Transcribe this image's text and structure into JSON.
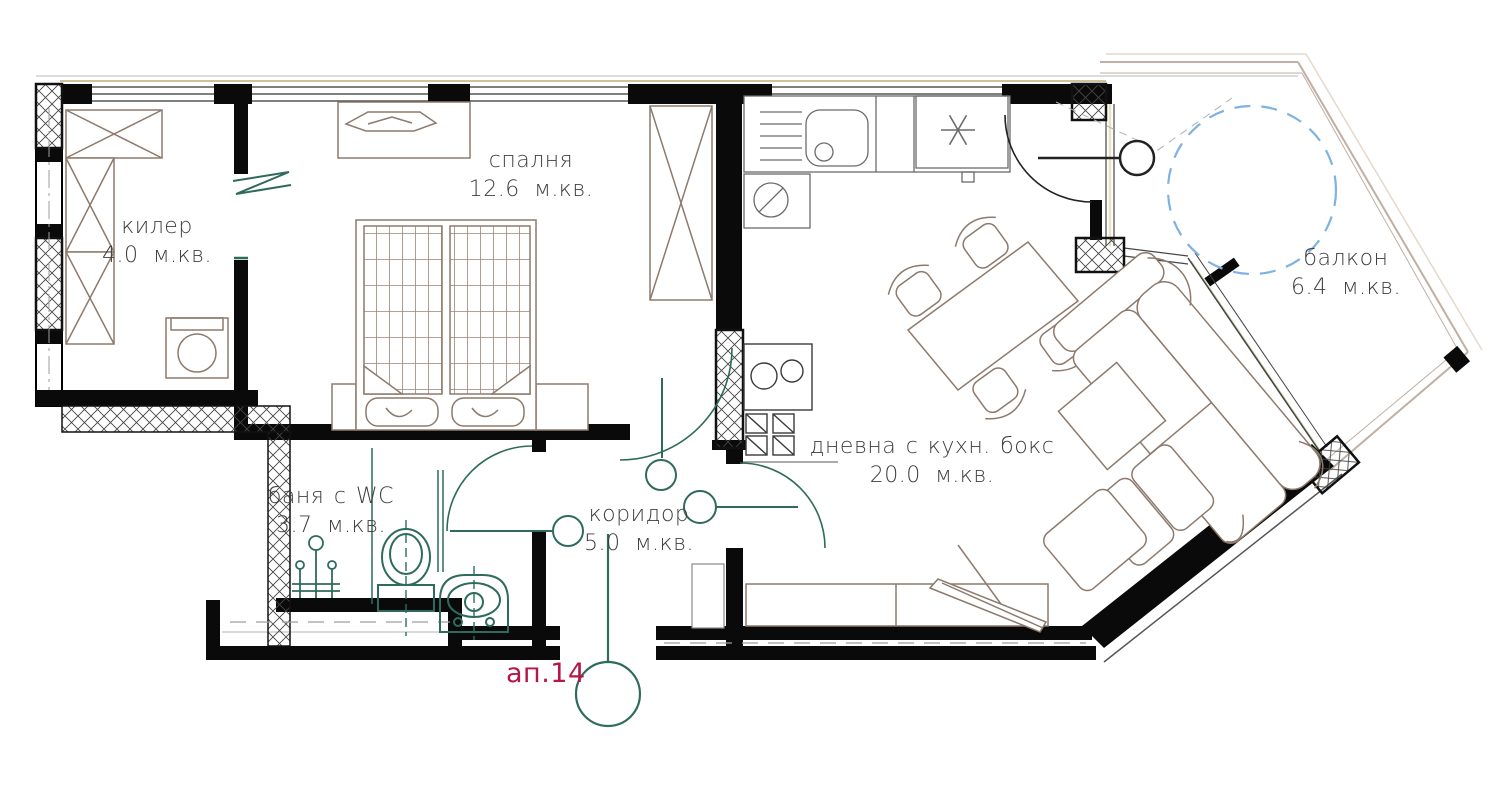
{
  "plan": {
    "apartment_label": "ап.14",
    "rooms": [
      {
        "key": "storage",
        "name": "килер",
        "area": "4.0 м.кв."
      },
      {
        "key": "bedroom",
        "name": "спалня",
        "area": "12.6 м.кв."
      },
      {
        "key": "bathroom",
        "name": "баня с WC",
        "area": "3.7 м.кв."
      },
      {
        "key": "corridor",
        "name": "коридор",
        "area": "5.0 м.кв."
      },
      {
        "key": "living-kitchen",
        "name": "дневна с кухн. бокс",
        "area": "20.0 м.кв."
      },
      {
        "key": "balcony",
        "name": "балкон",
        "area": "6.4 м.кв."
      }
    ],
    "colors": {
      "walls": "#0a0a0a",
      "furniture_outline": "#8d7a6d",
      "plumbing_fixtures": "#2e6b5c",
      "apartment_label_red": "#b51747",
      "balcony_dashed_circle": "#7fb2e0",
      "window_sill_tan": "#cfc39a"
    }
  }
}
